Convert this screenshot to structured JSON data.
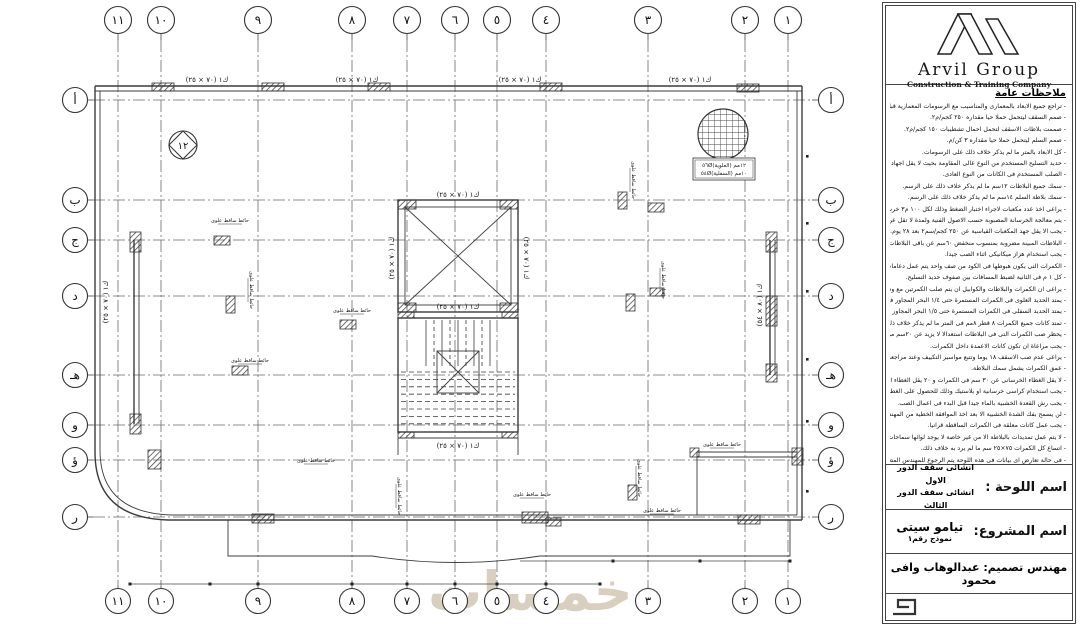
{
  "watermark": "خمسات",
  "grid": {
    "cols": [
      "١١",
      "١٠",
      "٩",
      "٨",
      "٧",
      "٦",
      "٥",
      "٤",
      "٣",
      "٢",
      "١"
    ],
    "rows": [
      "أ",
      "ب",
      "ج",
      "د",
      "هـ",
      "و",
      "ؤ",
      "ر"
    ]
  },
  "plan": {
    "beam_label": "(٧٠ × ٢٥) ك١",
    "beam_label_side": "(٨٠ × ٥٤) ك١",
    "section_marker": "١٢",
    "rebar_top": "٥٦Ø١٢مم (العلوية)",
    "rebar_bottom": "٥٤Ø١٠مم (السفلية)",
    "annotations": [
      "حائط ساقط علوى",
      "حائط ساقط علوى",
      "حائط ساقط علوى",
      "حائط ساقط علوى",
      "حائط ساقط علوى",
      "حائط ساقط علوى",
      "حائط ساقط علوى",
      "حائط ساقط علوى",
      "حائط ساقط علوى",
      "حائط ساقط علوى",
      "حائط ساقط علوى",
      "حائط ساقط علوى"
    ]
  },
  "panel": {
    "logo": {
      "name": "Arvil Group",
      "subtitle": "Construction & Training Company"
    },
    "notes": {
      "title": "ملاحظات عامة",
      "lines": [
        "- تراجع جميع الابعاد بالمعمارى والمناسيب مع الرسومات المعمارية قبل التنفيذ.",
        "- صمم السقف ليتحمل حملا حيا مقداره ٢٥٠ كجم/م٢.",
        "- صممت بلاطات الاسقف لتحمل احمال تشطيبات ١٥٠ كجم/م٢.",
        "- صمم السلم ليتحمل حملا حيا مقداره ٣ كن/م.",
        "- كل الابعاد بالمتر ما لم يذكر خلاف ذلك على الرسومات.",
        "- حديد التسليح المستخدم من النوع عالى المقاومة بحيث لا يقل اجهاد الخضوع له عن ٣٦٠٠ كجم/سم٢.",
        "- الصلب المستخدم فى الكانات من النوع العادى.",
        "- سمك جميع البلاطات ١٢سم ما لم يذكر خلاف ذلك على الرسم.",
        "- سمك بلاطة السلم ١٤سم ما لم يذكر خلاف ذلك على الرسم.",
        "- يراعى اخذ عدد مكعبات لاجراء اختبار الضغط وذلك لكل ١٠٠ م٣ خرسانة.",
        "- يتم معالجة الخرسانة المصبوبة حسب الاصول الفنية ولمدة لا تقل عن ٧ ايام.",
        "- يجب الا يقل جهد المكعبات القياسية عن ٢٥٠ كجم/سم٢ بعد ٢٨ يوم.",
        "- البلاطات المبينة مضروبة بمنسوب منخفض ٦٠سم عن باقى البلاطات المسقطة ما لم يذكر خلاف ذلك.",
        "- يجب استخدام هزاز ميكانيكى اثناء الصب جيدا.",
        "- الكمرات التى يكون هبوطها فى الكود من صف واحد يتم عمل دعامات ٢٥سم.",
        "- كل ١ م فى الثانية لضبط المسافات بين صفوف حديد التسليح.",
        "- يراعى ان الكمرات والبلاطات والكوابيل ان يتم صلب الكمرتين مع وصلات حول الكوابيل داخل البحر الموضح.",
        "- يمتد الحديد العلوى فى الكمرات المستمرة حتى ١/٤ البحر المجاور فى حالة الكمرات المستمرة الاكبر من بحر.",
        "- يمتد الحديد السفلى فى الكمرات المستمرة حتى ١/٥ البحر المجاور فى حالة وجود بحرين.",
        "- تمتد كانات جميع الكمرات ٨ قطر ٨مم فى المتر ما لم يذكر خلاف ذلك.",
        "- يحظر صب الكمرات التى فى البلاطات استعدالا لا يزيد عن ٢٠سم من حول الكمرات التى يزيد سمكها عن ٥٠سم.",
        "- يجب مراعاة ان تكون كانات الاعمدة داخل الكمرات.",
        "- يراعى عدم صب الاسقف ١٨ يوما وتتبع مواسير التكييف وعند مراجعة الاعمال المدنية والكهربية.",
        "- عمق الكمرات يشمل سمك البلاطة.",
        "- لا يقل الغطاء الخرسانى عن ٣٠ سم فى الكمرات و ٢٠ يقل الغطاء الخرسانى عن ٥٠ سم فى البلاطة.",
        "- يجب استخدام كراسى خرسانية او بلاستيك وذلك للحصول على الغطاء الخرسانى لتحديد الابعاد المذكورة.",
        "- يجب رش القعدة الخشبية بالماء جيدا قبل البدء فى اعمال الصب.",
        "- لن يسمح بفك الشدة الخشبية الا بعد اخذ الموافقة الخطية من المهندس المشرف.",
        "- يجب عمل كانات معلقة فى الكمرات الساقطة قرانيا.",
        "- لا يتم عمل تمديدات بالبلاطة الا من غير خاصة لا يوجد لوائها سماحات.",
        "- اتساع كل الكمرات ٧٥×٢٥ سم ما لم يرد به خلاف ذلك.",
        "- فى حالة تعارض اى بيانات فى هذه اللوحة يتم الرجوع للمهندس المصمم او الكود المصرى وتعليمات المنشآت الخرسانية المسلحة (طبقا لآخر حديث)."
      ]
    },
    "titleblock": {
      "sheet_label": "اسم اللوحة :",
      "sheet_line1": "انشائى سقف الدور الاول",
      "sheet_line2": "انشائى سقف الدور الثالث",
      "project_label": "اسم المشروع:",
      "project_name": "تيامو سيتى",
      "project_model": "نموذج رقم١",
      "engineer_label": "مهندس تصميم:",
      "engineer_name": "عبدالوهاب وافى محمود"
    }
  }
}
